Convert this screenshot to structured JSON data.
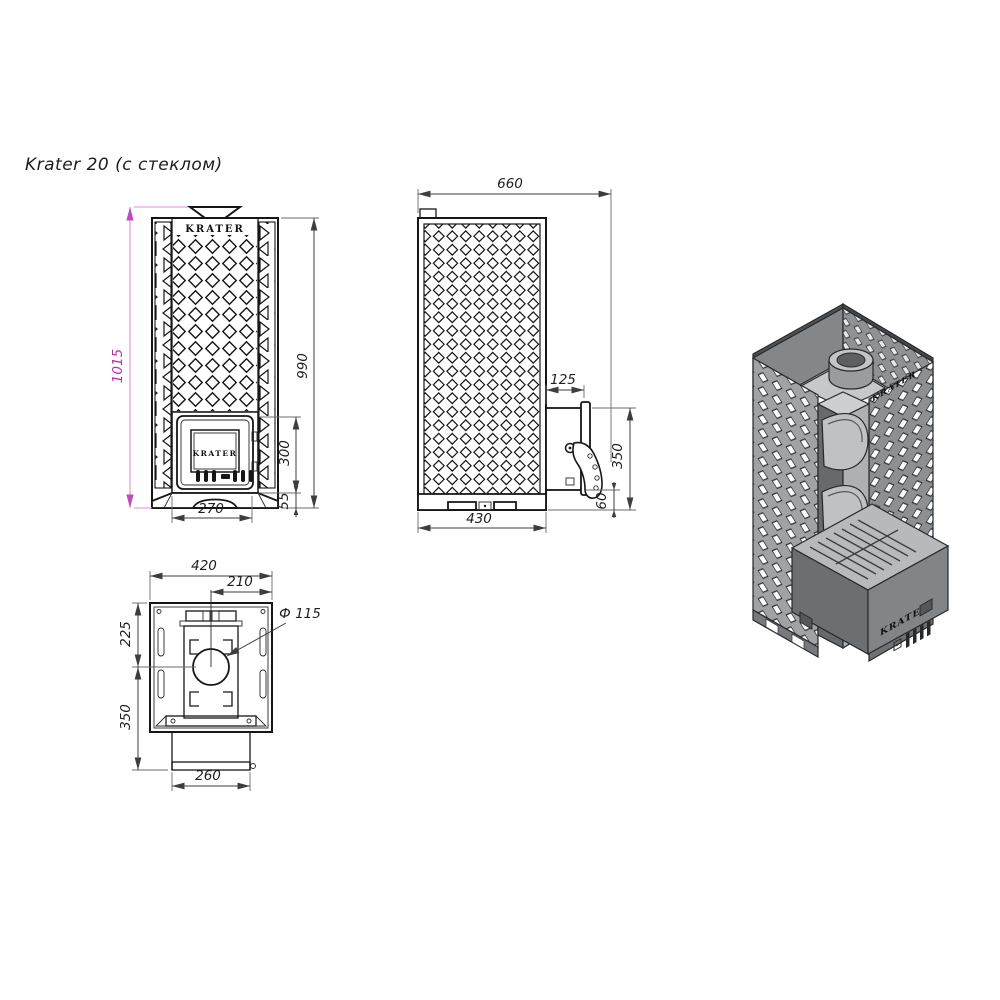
{
  "title": "Krater 20 (с стеклом)",
  "colors": {
    "accent_magenta": "#b433b4",
    "line": "#161616",
    "dim_line": "#3d3d3d"
  },
  "views": {
    "front": {
      "name": "front-orthographic-view",
      "brand_top": "KRATER",
      "brand_door": "KRATER",
      "dims": {
        "total_height": "1015",
        "body_height": "990",
        "door_height": "300",
        "base_height": "55",
        "door_width": "270"
      }
    },
    "side": {
      "name": "side-orthographic-view",
      "dims": {
        "total_depth": "660",
        "tunnel_depth": "125",
        "tunnel_top_height": "350",
        "tunnel_bottom_height": "60",
        "body_depth": "430"
      }
    },
    "top": {
      "name": "top-orthographic-view",
      "dims": {
        "body_width": "420",
        "chimney_to_edge": "210",
        "chimney_from_front": "225",
        "tunnel_reach": "350",
        "tunnel_width": "260",
        "chimney_diameter": "Ф 115"
      }
    },
    "iso": {
      "name": "isometric-3d-view",
      "brand_panel": "KRATER",
      "brand_tunnel": "KRATER"
    }
  }
}
